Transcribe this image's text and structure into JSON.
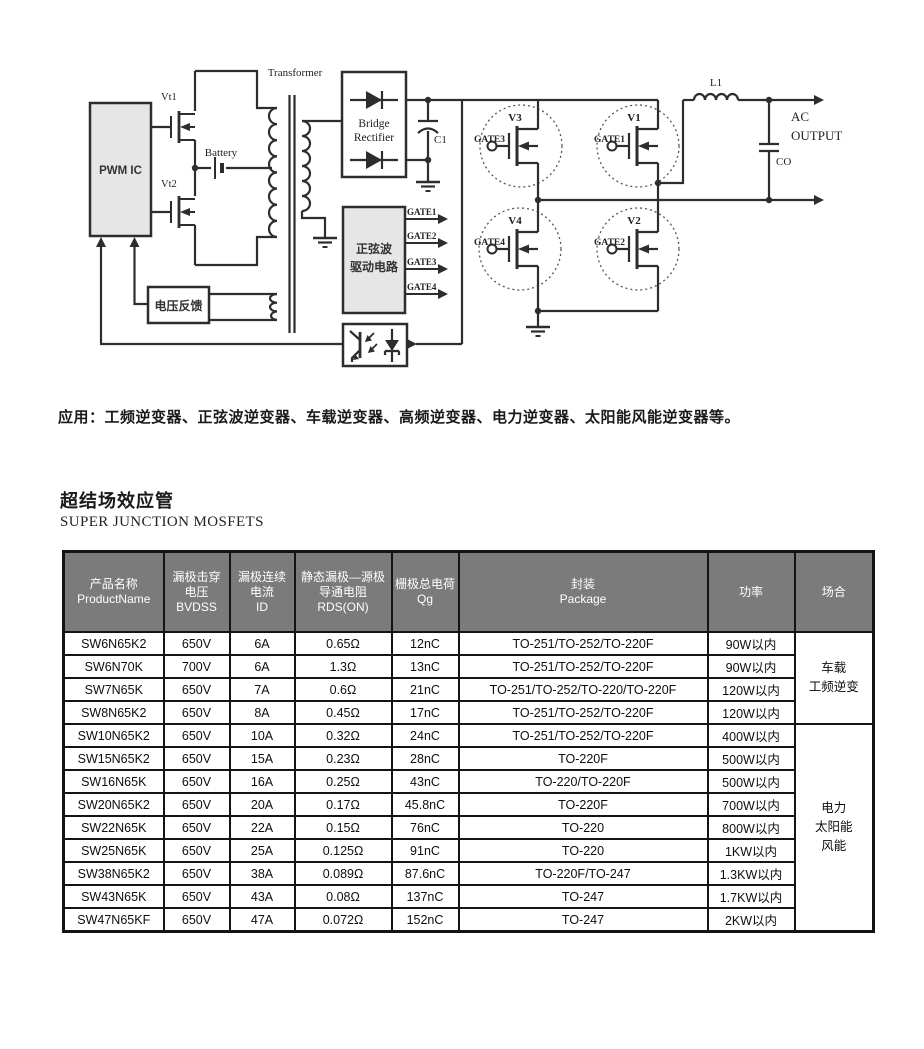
{
  "diagram": {
    "labels": {
      "transformer": "Transformer",
      "vt1": "Vt1",
      "vt2": "Vt2",
      "battery": "Battery",
      "pwm_ic": "PWM IC",
      "voltage_feedback": "电压反馈",
      "bridge1": "Bridge",
      "bridge2": "Rectifier",
      "c1": "C1",
      "drive1": "正弦波",
      "drive2": "驱动电路",
      "gate1": "GATE1",
      "gate2": "GATE2",
      "gate3": "GATE3",
      "gate4": "GATE4",
      "v1": "V1",
      "v2": "V2",
      "v3": "V3",
      "v4": "V4",
      "l1": "L1",
      "ac": "AC",
      "output": "OUTPUT",
      "co": "CO"
    }
  },
  "application": {
    "text": "应用：工频逆变器、正弦波逆变器、车载逆变器、高频逆变器、电力逆变器、太阳能风能逆变器等。"
  },
  "section": {
    "title_cn": "超结场效应管",
    "title_en": "SUPER JUNCTION MOSFETS"
  },
  "table": {
    "header_bg": "#7b7b7b",
    "headers": [
      {
        "lines": [
          "产品名称",
          "ProductName"
        ]
      },
      {
        "lines": [
          "漏极击穿",
          "电压",
          "BVDSS"
        ]
      },
      {
        "lines": [
          "漏极连续",
          "电流",
          "ID"
        ]
      },
      {
        "lines": [
          "静态漏极—源极",
          "导通电阻",
          "RDS(ON)"
        ]
      },
      {
        "lines": [
          "栅极总电荷",
          "Qg"
        ]
      },
      {
        "lines": [
          "封装",
          "Package"
        ]
      },
      {
        "lines": [
          "功率"
        ]
      },
      {
        "lines": [
          "场合"
        ]
      }
    ],
    "rows": [
      [
        "SW6N65K2",
        "650V",
        "6A",
        "0.65Ω",
        "12nC",
        "TO-251/TO-252/TO-220F",
        "90W以内"
      ],
      [
        "SW6N70K",
        "700V",
        "6A",
        "1.3Ω",
        "13nC",
        "TO-251/TO-252/TO-220F",
        "90W以内"
      ],
      [
        "SW7N65K",
        "650V",
        "7A",
        "0.6Ω",
        "21nC",
        "TO-251/TO-252/TO-220/TO-220F",
        "120W以内"
      ],
      [
        "SW8N65K2",
        "650V",
        "8A",
        "0.45Ω",
        "17nC",
        "TO-251/TO-252/TO-220F",
        "120W以内"
      ],
      [
        "SW10N65K2",
        "650V",
        "10A",
        "0.32Ω",
        "24nC",
        "TO-251/TO-252/TO-220F",
        "400W以内"
      ],
      [
        "SW15N65K2",
        "650V",
        "15A",
        "0.23Ω",
        "28nC",
        "TO-220F",
        "500W以内"
      ],
      [
        "SW16N65K",
        "650V",
        "16A",
        "0.25Ω",
        "43nC",
        "TO-220/TO-220F",
        "500W以内"
      ],
      [
        "SW20N65K2",
        "650V",
        "20A",
        "0.17Ω",
        "45.8nC",
        "TO-220F",
        "700W以内"
      ],
      [
        "SW22N65K",
        "650V",
        "22A",
        "0.15Ω",
        "76nC",
        "TO-220",
        "800W以内"
      ],
      [
        "SW25N65K",
        "650V",
        "25A",
        "0.125Ω",
        "91nC",
        "TO-220",
        "1KW以内"
      ],
      [
        "SW38N65K2",
        "650V",
        "38A",
        "0.089Ω",
        "87.6nC",
        "TO-220F/TO-247",
        "1.3KW以内"
      ],
      [
        "SW43N65K",
        "650V",
        "43A",
        "0.08Ω",
        "137nC",
        "TO-247",
        "1.7KW以内"
      ],
      [
        "SW47N65KF",
        "650V",
        "47A",
        "0.072Ω",
        "152nC",
        "TO-247",
        "2KW以内"
      ]
    ],
    "groups": [
      {
        "label": "车载\n工频逆变",
        "span": 4
      },
      {
        "label": "电力\n太阳能\n风能",
        "span": 9
      }
    ]
  }
}
